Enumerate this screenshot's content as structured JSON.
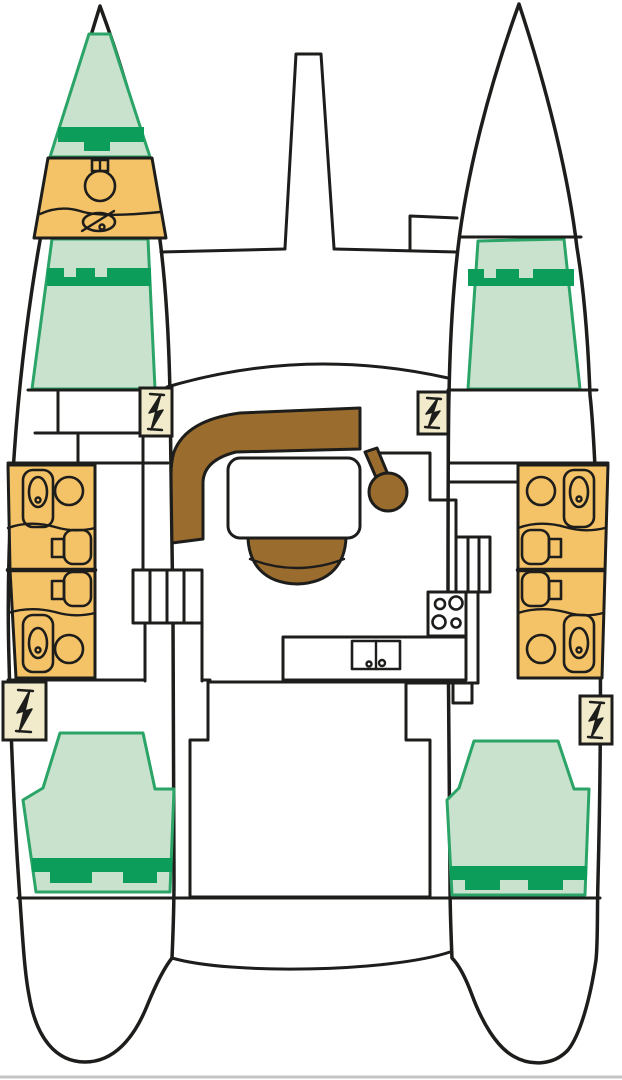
{
  "plan": {
    "type": "catamaran-deck-plan",
    "text_labels": [],
    "rooms": [
      {
        "name": "port-bow-berth",
        "kind": "berth"
      },
      {
        "name": "port-bow-head",
        "kind": "bathroom"
      },
      {
        "name": "port-forward-cabin",
        "kind": "berth"
      },
      {
        "name": "starboard-forward-cabin",
        "kind": "berth"
      },
      {
        "name": "port-heads",
        "kind": "bathroom"
      },
      {
        "name": "starboard-heads",
        "kind": "bathroom"
      },
      {
        "name": "salon",
        "kind": "seating"
      },
      {
        "name": "galley",
        "kind": "kitchen"
      },
      {
        "name": "port-aft-cabin",
        "kind": "berth"
      },
      {
        "name": "starboard-aft-cabin",
        "kind": "berth"
      }
    ],
    "fixtures": [
      "toilet-icon",
      "sink-icon",
      "washbasin-icon",
      "vanity-icon",
      "stove-icon",
      "double-sink-icon",
      "settee-icon",
      "table-icon",
      "bench-icon",
      "stool-icon",
      "companionway-steps-icon",
      "bolt-steps-marker-icon",
      "bowsprit-icon",
      "crossbeam-icon",
      "transom-icon"
    ]
  },
  "colors": {
    "ink": "#1d1d1b",
    "berth_light": "#c9e2cd",
    "berth_border": "#2ba467",
    "berth_dark": "#0c9d5b",
    "head_orange": "#f4c267",
    "wood": "#9a6c2d",
    "steps_beige": "#f1ebcb",
    "background": "#ffffff",
    "baseline_gray": "#c4c4c4"
  }
}
